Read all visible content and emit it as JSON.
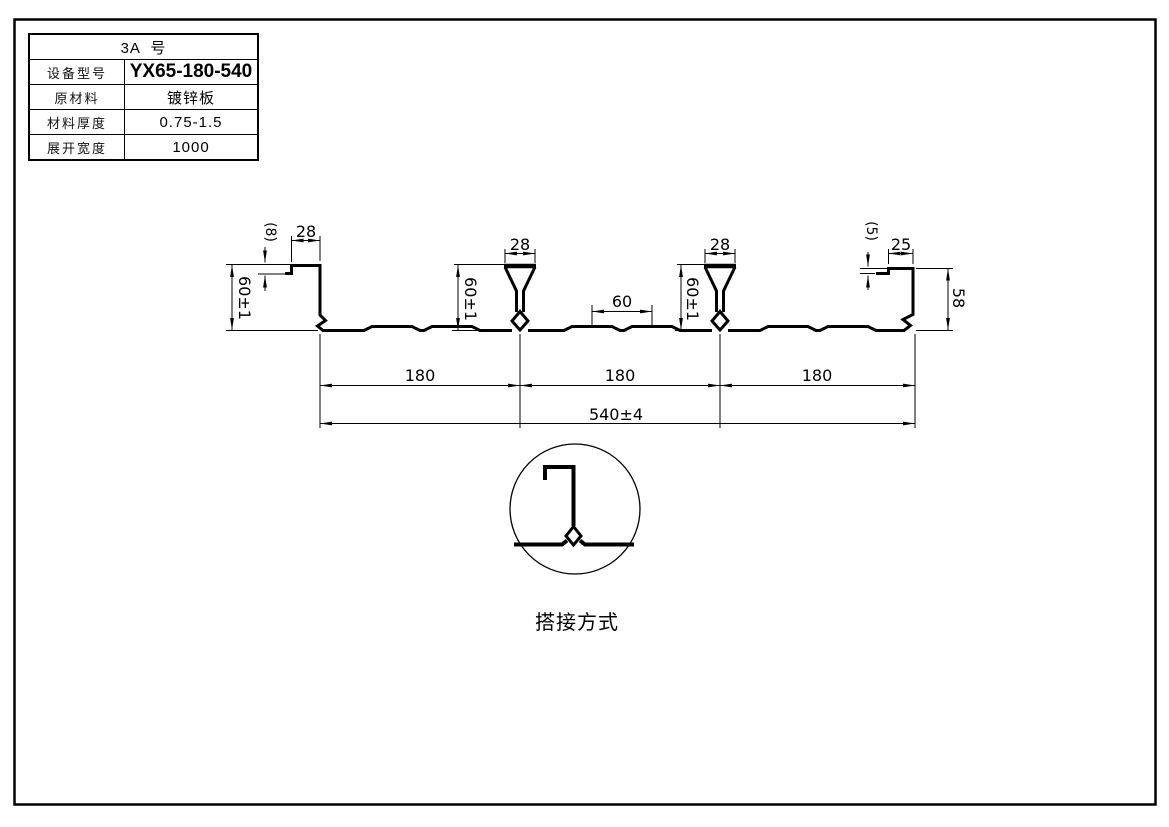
{
  "colors": {
    "line": "#000000",
    "background": "#ffffff"
  },
  "spec_table": {
    "title": "3A  号",
    "rows": [
      {
        "label": "设备型号",
        "value": "YX65-180-540"
      },
      {
        "label": "原材料",
        "value": "镀锌板"
      },
      {
        "label": "材料厚度",
        "value": "0.75-1.5"
      },
      {
        "label": "展开宽度",
        "value": "1000"
      }
    ]
  },
  "profile_drawing": {
    "dims": {
      "left_lip_height": "(8)",
      "left_flange_width": "28",
      "left_web_height": "60±1",
      "rib1_top_width": "28",
      "rib1_height": "60±1",
      "emboss_spacing": "60",
      "rib2_top_width": "28",
      "rib2_height": "60±1",
      "right_lip_height": "(5)",
      "right_flange_width": "25",
      "right_web_height": "58",
      "pitch_1": "180",
      "pitch_2": "180",
      "pitch_3": "180",
      "cover_width": "540±4"
    }
  },
  "lap_detail": {
    "caption": "搭接方式"
  }
}
